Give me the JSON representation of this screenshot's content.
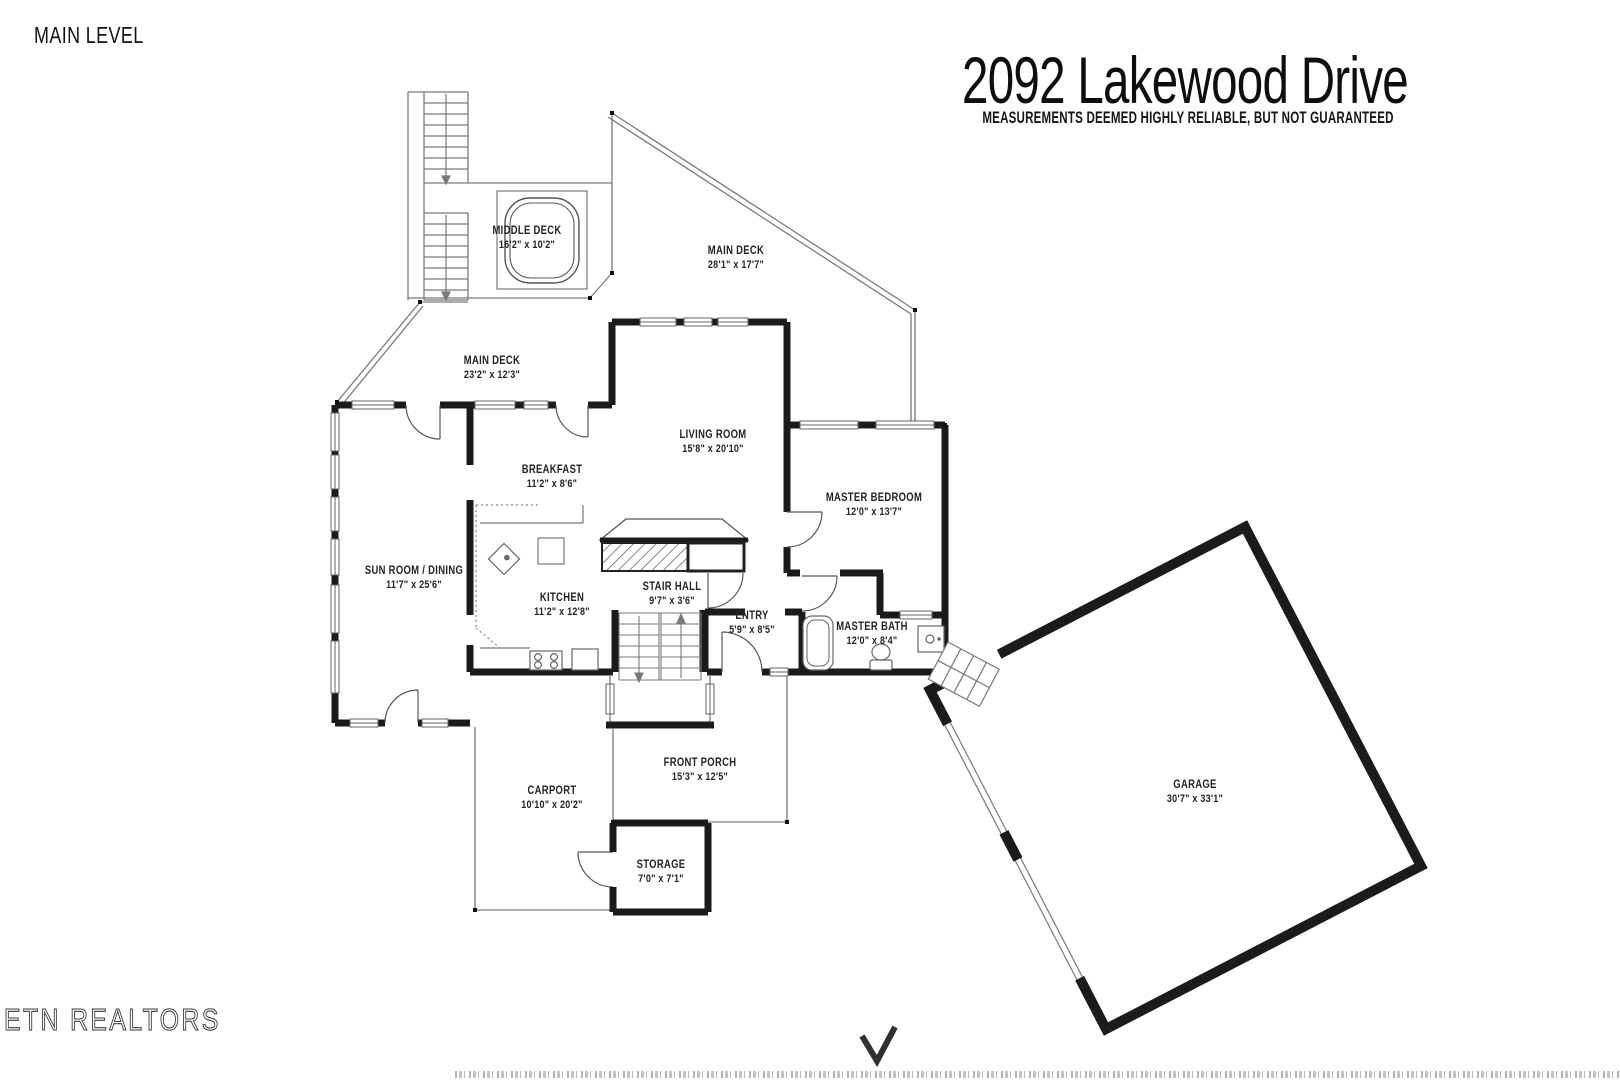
{
  "header": {
    "level_label": "MAIN LEVEL",
    "title": "2092 Lakewood Drive",
    "disclaimer": "MEASUREMENTS DEEMED HIGHLY RELIABLE, BUT NOT GUARANTEED"
  },
  "watermark": "ETN REALTORS",
  "rooms": [
    {
      "name": "MIDDLE DECK",
      "dims": "16'2\" x 10'2\""
    },
    {
      "name": "MAIN DECK",
      "dims": "28'1\" x 17'7\""
    },
    {
      "name": "MAIN DECK",
      "dims": "23'2\" x 12'3\""
    },
    {
      "name": "LIVING ROOM",
      "dims": "15'8\" x 20'10\""
    },
    {
      "name": "BREAKFAST",
      "dims": "11'2\" x 8'6\""
    },
    {
      "name": "SUN ROOM / DINING",
      "dims": "11'7\" x 25'6\""
    },
    {
      "name": "KITCHEN",
      "dims": "11'2\" x 12'8\""
    },
    {
      "name": "STAIR HALL",
      "dims": "9'7\" x 3'6\""
    },
    {
      "name": "ENTRY",
      "dims": "5'9\" x 8'5\""
    },
    {
      "name": "MASTER BEDROOM",
      "dims": "12'0\" x 13'7\""
    },
    {
      "name": "MASTER BATH",
      "dims": "12'0\" x 8'4\""
    },
    {
      "name": "CARPORT",
      "dims": "10'10\" x 20'2\""
    },
    {
      "name": "FRONT PORCH",
      "dims": "15'3\" x 12'5\""
    },
    {
      "name": "STORAGE",
      "dims": "7'0\" x 7'1\""
    },
    {
      "name": "GARAGE",
      "dims": "30'7\" x 33'1\""
    }
  ],
  "colors": {
    "wall": "#1b1b1b",
    "thin_line": "#7a7a7a",
    "text": "#232323"
  }
}
